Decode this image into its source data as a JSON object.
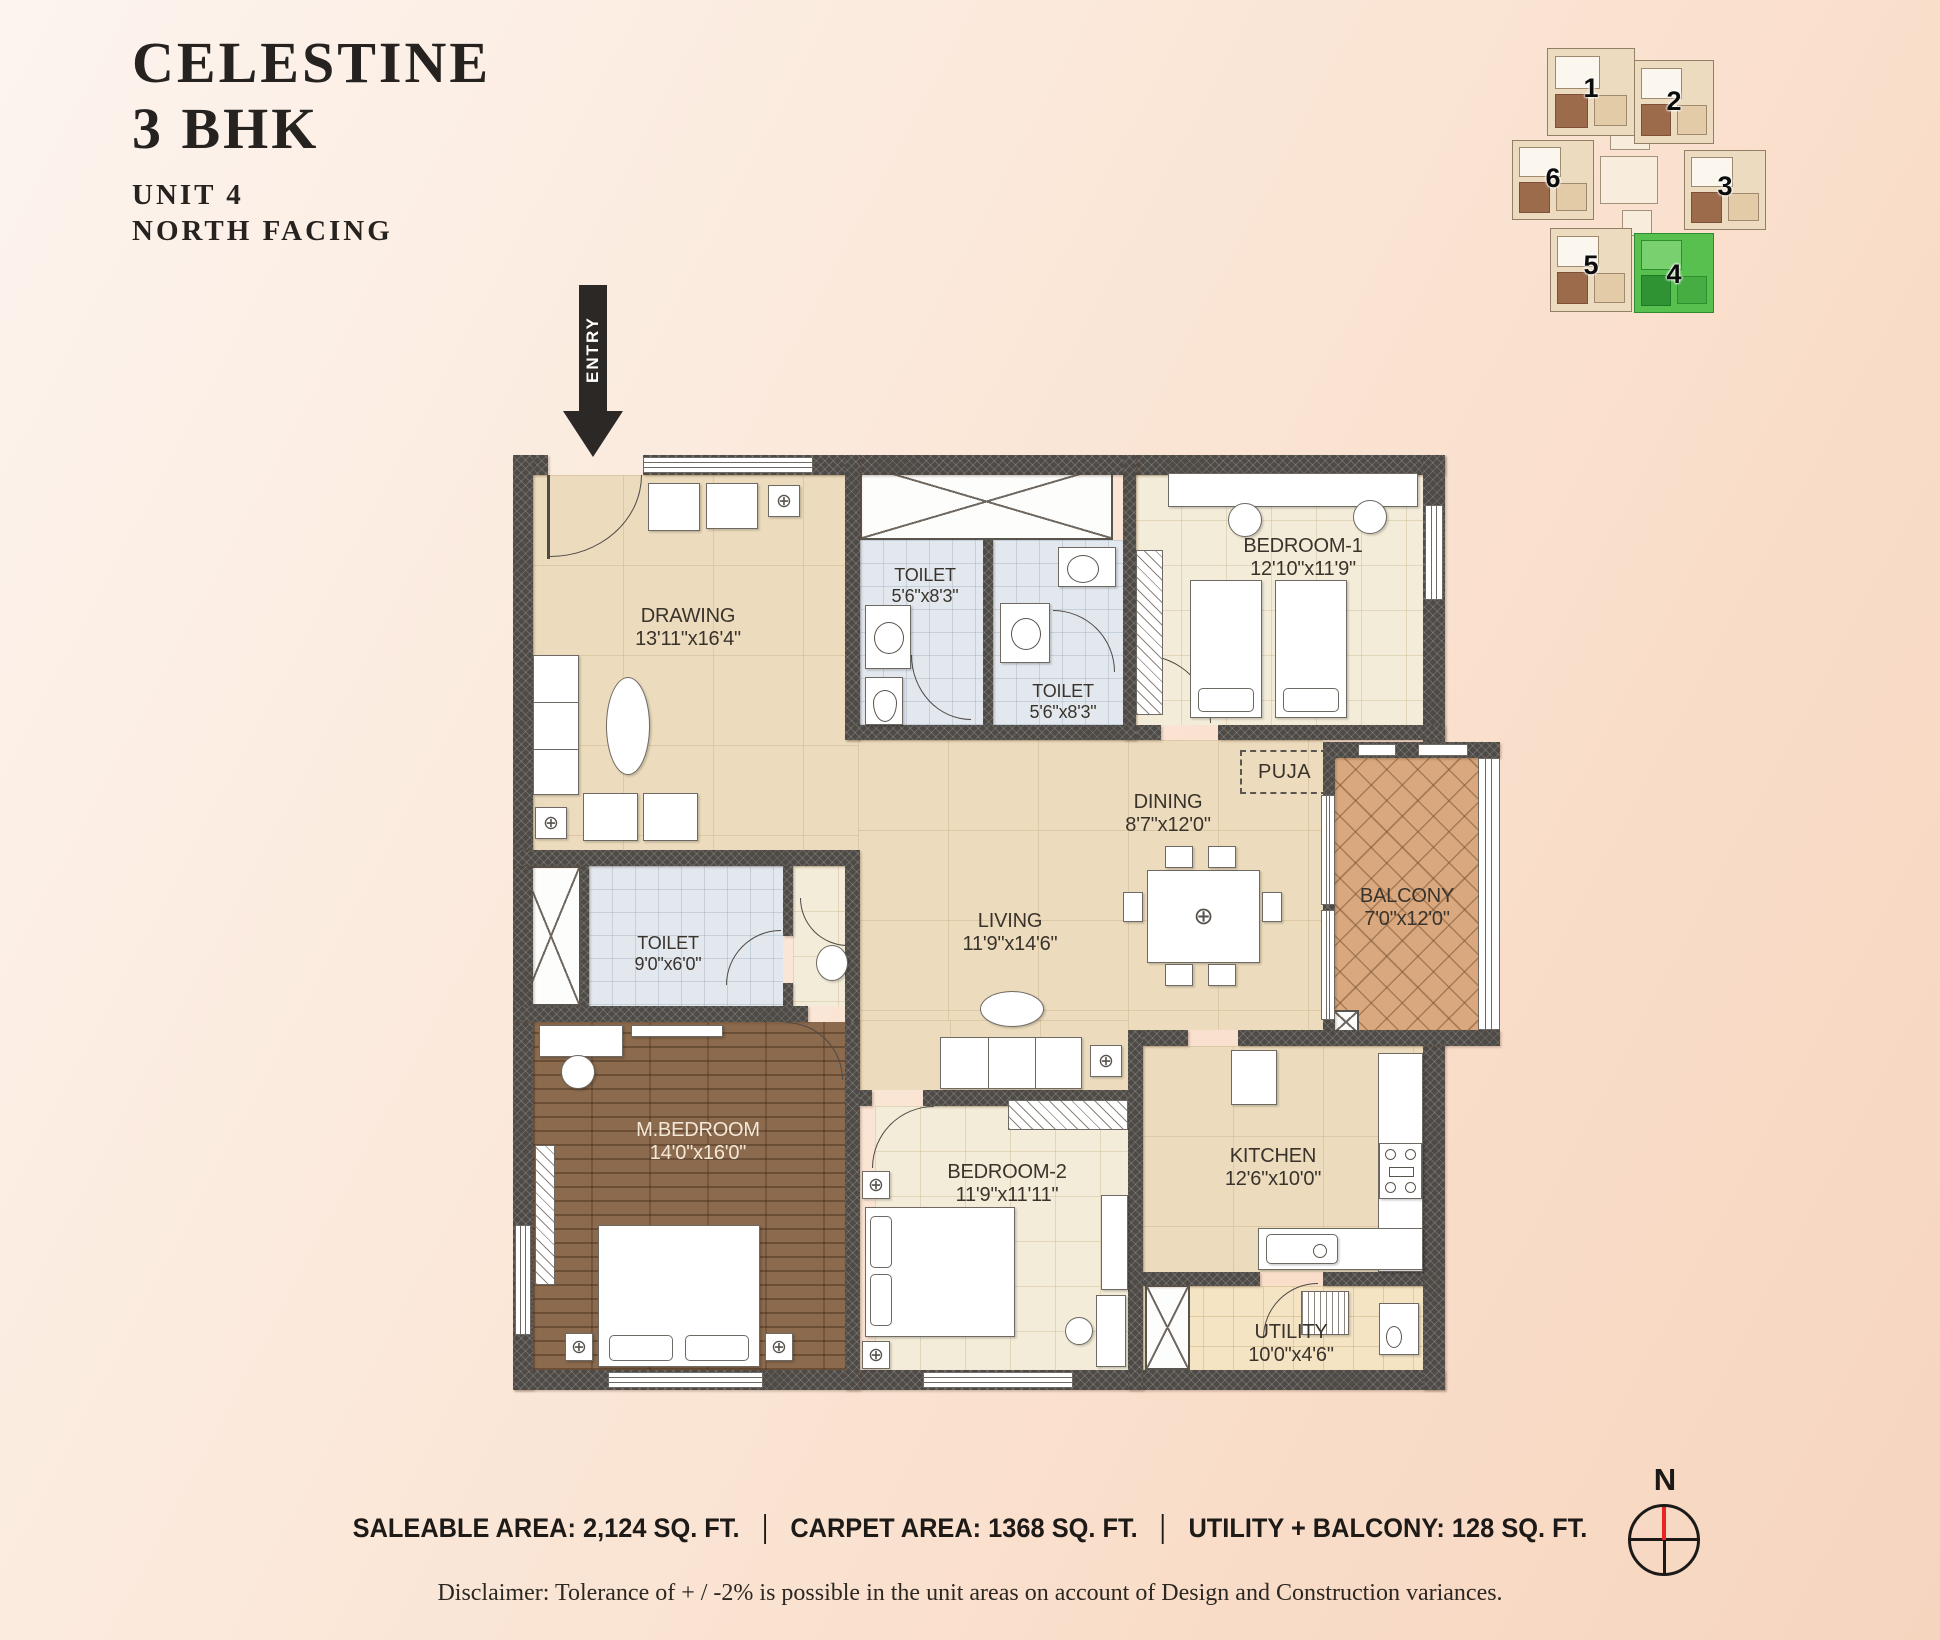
{
  "title": {
    "line1": "CELESTINE",
    "line2": "3 BHK",
    "unit": "UNIT 4",
    "facing": "NORTH FACING"
  },
  "entry_label": "ENTRY",
  "compass_label": "N",
  "key_plan": {
    "units": [
      {
        "label": "1"
      },
      {
        "label": "2"
      },
      {
        "label": "3"
      },
      {
        "label": "4"
      },
      {
        "label": "5"
      },
      {
        "label": "6"
      }
    ],
    "highlighted_unit": "4"
  },
  "rooms": [
    {
      "id": "drawing",
      "name": "DRAWING",
      "dims": "13'11\"x16'4\""
    },
    {
      "id": "toilet-a",
      "name": "TOILET",
      "dims": "5'6\"x8'3\""
    },
    {
      "id": "toilet-b",
      "name": "TOILET",
      "dims": "5'6\"x8'3\""
    },
    {
      "id": "bedroom1",
      "name": "BEDROOM-1",
      "dims": "12'10\"x11'9\""
    },
    {
      "id": "puja",
      "name": "PUJA",
      "dims": ""
    },
    {
      "id": "dining",
      "name": "DINING",
      "dims": "8'7\"x12'0\""
    },
    {
      "id": "balcony",
      "name": "BALCONY",
      "dims": "7'0\"x12'0\""
    },
    {
      "id": "living",
      "name": "LIVING",
      "dims": "11'9\"x14'6\""
    },
    {
      "id": "toilet-c",
      "name": "TOILET",
      "dims": "9'0\"x6'0\""
    },
    {
      "id": "mbedroom",
      "name": "M.BEDROOM",
      "dims": "14'0\"x16'0\""
    },
    {
      "id": "bedroom2",
      "name": "BEDROOM-2",
      "dims": "11'9\"x11'11\""
    },
    {
      "id": "kitchen",
      "name": "KITCHEN",
      "dims": "12'6\"x10'0\""
    },
    {
      "id": "utility",
      "name": "UTILITY",
      "dims": "10'0\"x4'6\""
    }
  ],
  "footer": {
    "saleable": "SALEABLE AREA: 2,124 SQ. FT.",
    "carpet": "CARPET AREA: 1368 SQ. FT.",
    "utility_balcony": "UTILITY + BALCONY: 128 SQ. FT.",
    "disclaimer": "Disclaimer: Tolerance of + / -2% is possible in the unit areas on account of Design and Construction variances."
  },
  "icons": {
    "crosshair": "⊕"
  },
  "colors": {
    "wall": "#4e4a46",
    "highlight_green": "#57c04f",
    "compass_north_red": "#e8261f",
    "floor_beige": "#ecdcbd",
    "floor_wood": "#8b6a4d",
    "floor_tile": "#e2e8ee",
    "floor_balcony": "#d9a87e"
  }
}
